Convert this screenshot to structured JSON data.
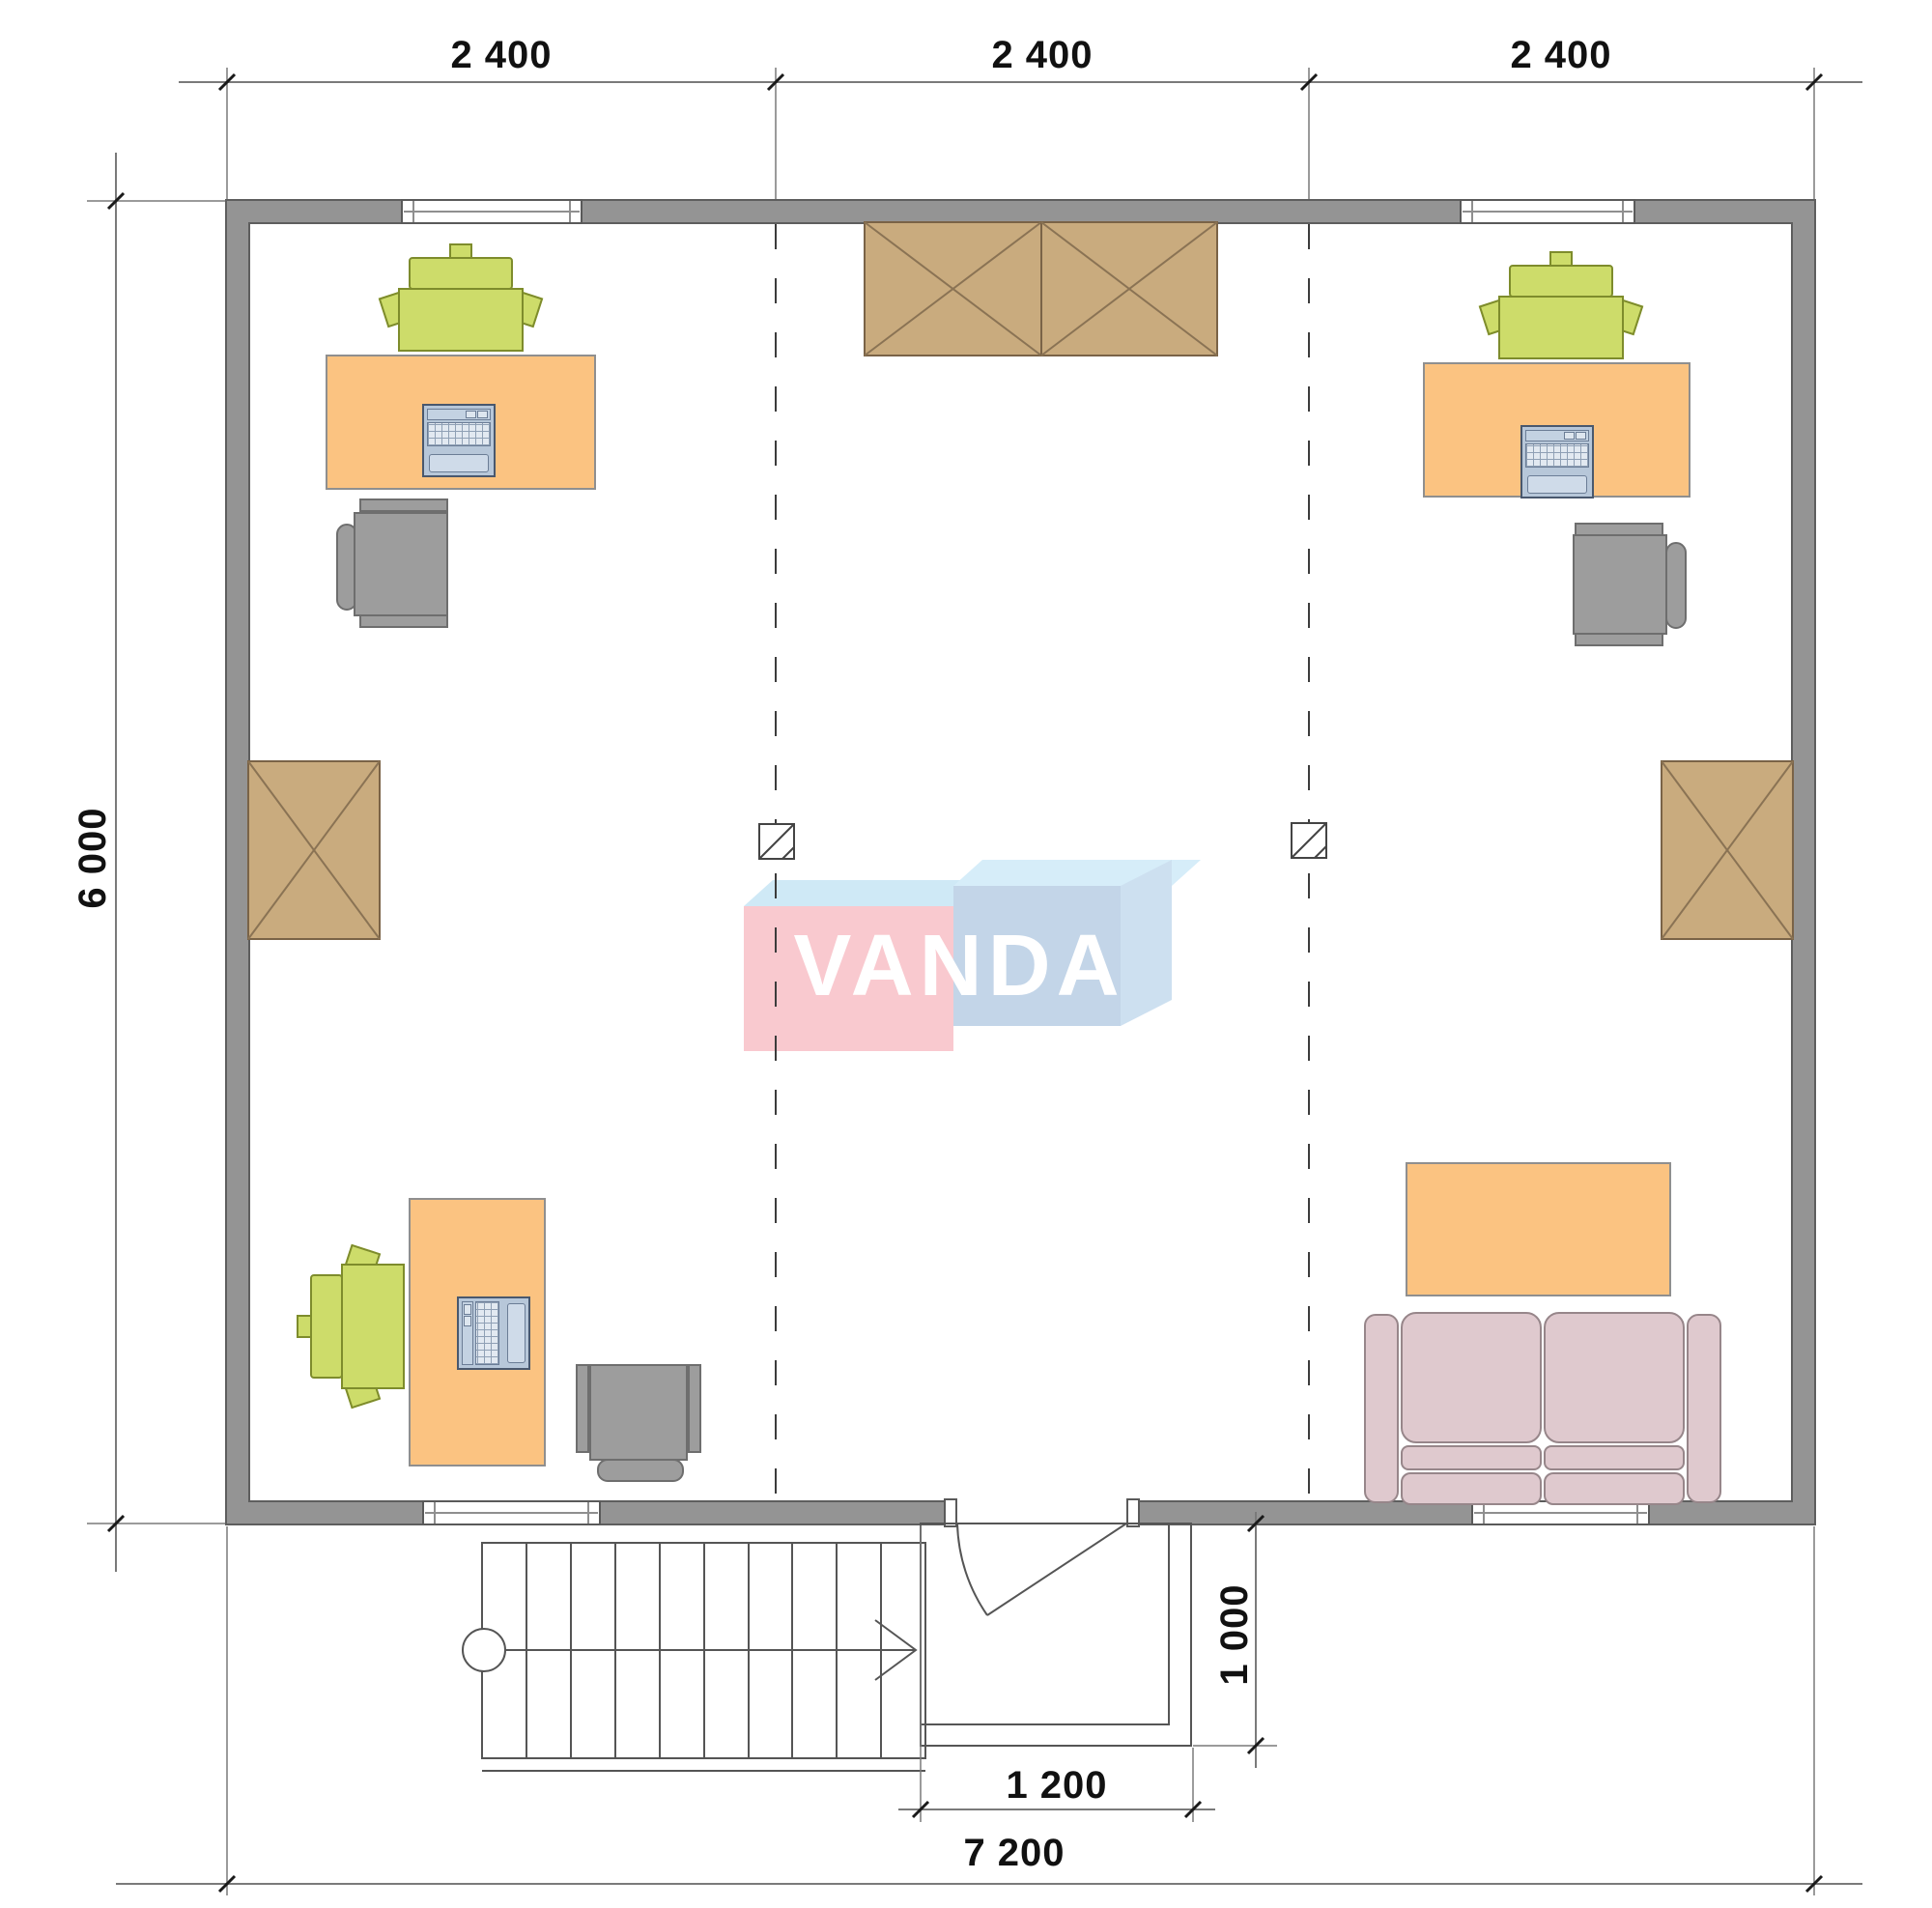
{
  "drawing": {
    "type": "floor-plan",
    "labels": {
      "dim_top_1": "2 400",
      "dim_top_2": "2 400",
      "dim_top_3": "2 400",
      "dim_left": "6 000",
      "dim_porch_depth": "1 000",
      "dim_porch_width": "1 200",
      "dim_total_width": "7 200",
      "watermark": "VANDA"
    },
    "colors": {
      "wall": "#949494",
      "desk_orange": "#fbc381",
      "wardrobe_brown": "#c9ab7e",
      "chair_green": "#cddc6a",
      "chair_gray": "#9d9d9d",
      "sofa_pink": "#dfc9ce",
      "laptop_blue": "#b7c7d9",
      "logo_pink": "#f9c9cf",
      "logo_blue": "#c3d5e8",
      "logo_light_blue": "#cfe9f6",
      "watermark_text": "#ffffff",
      "dimension_text": "#111111"
    }
  }
}
